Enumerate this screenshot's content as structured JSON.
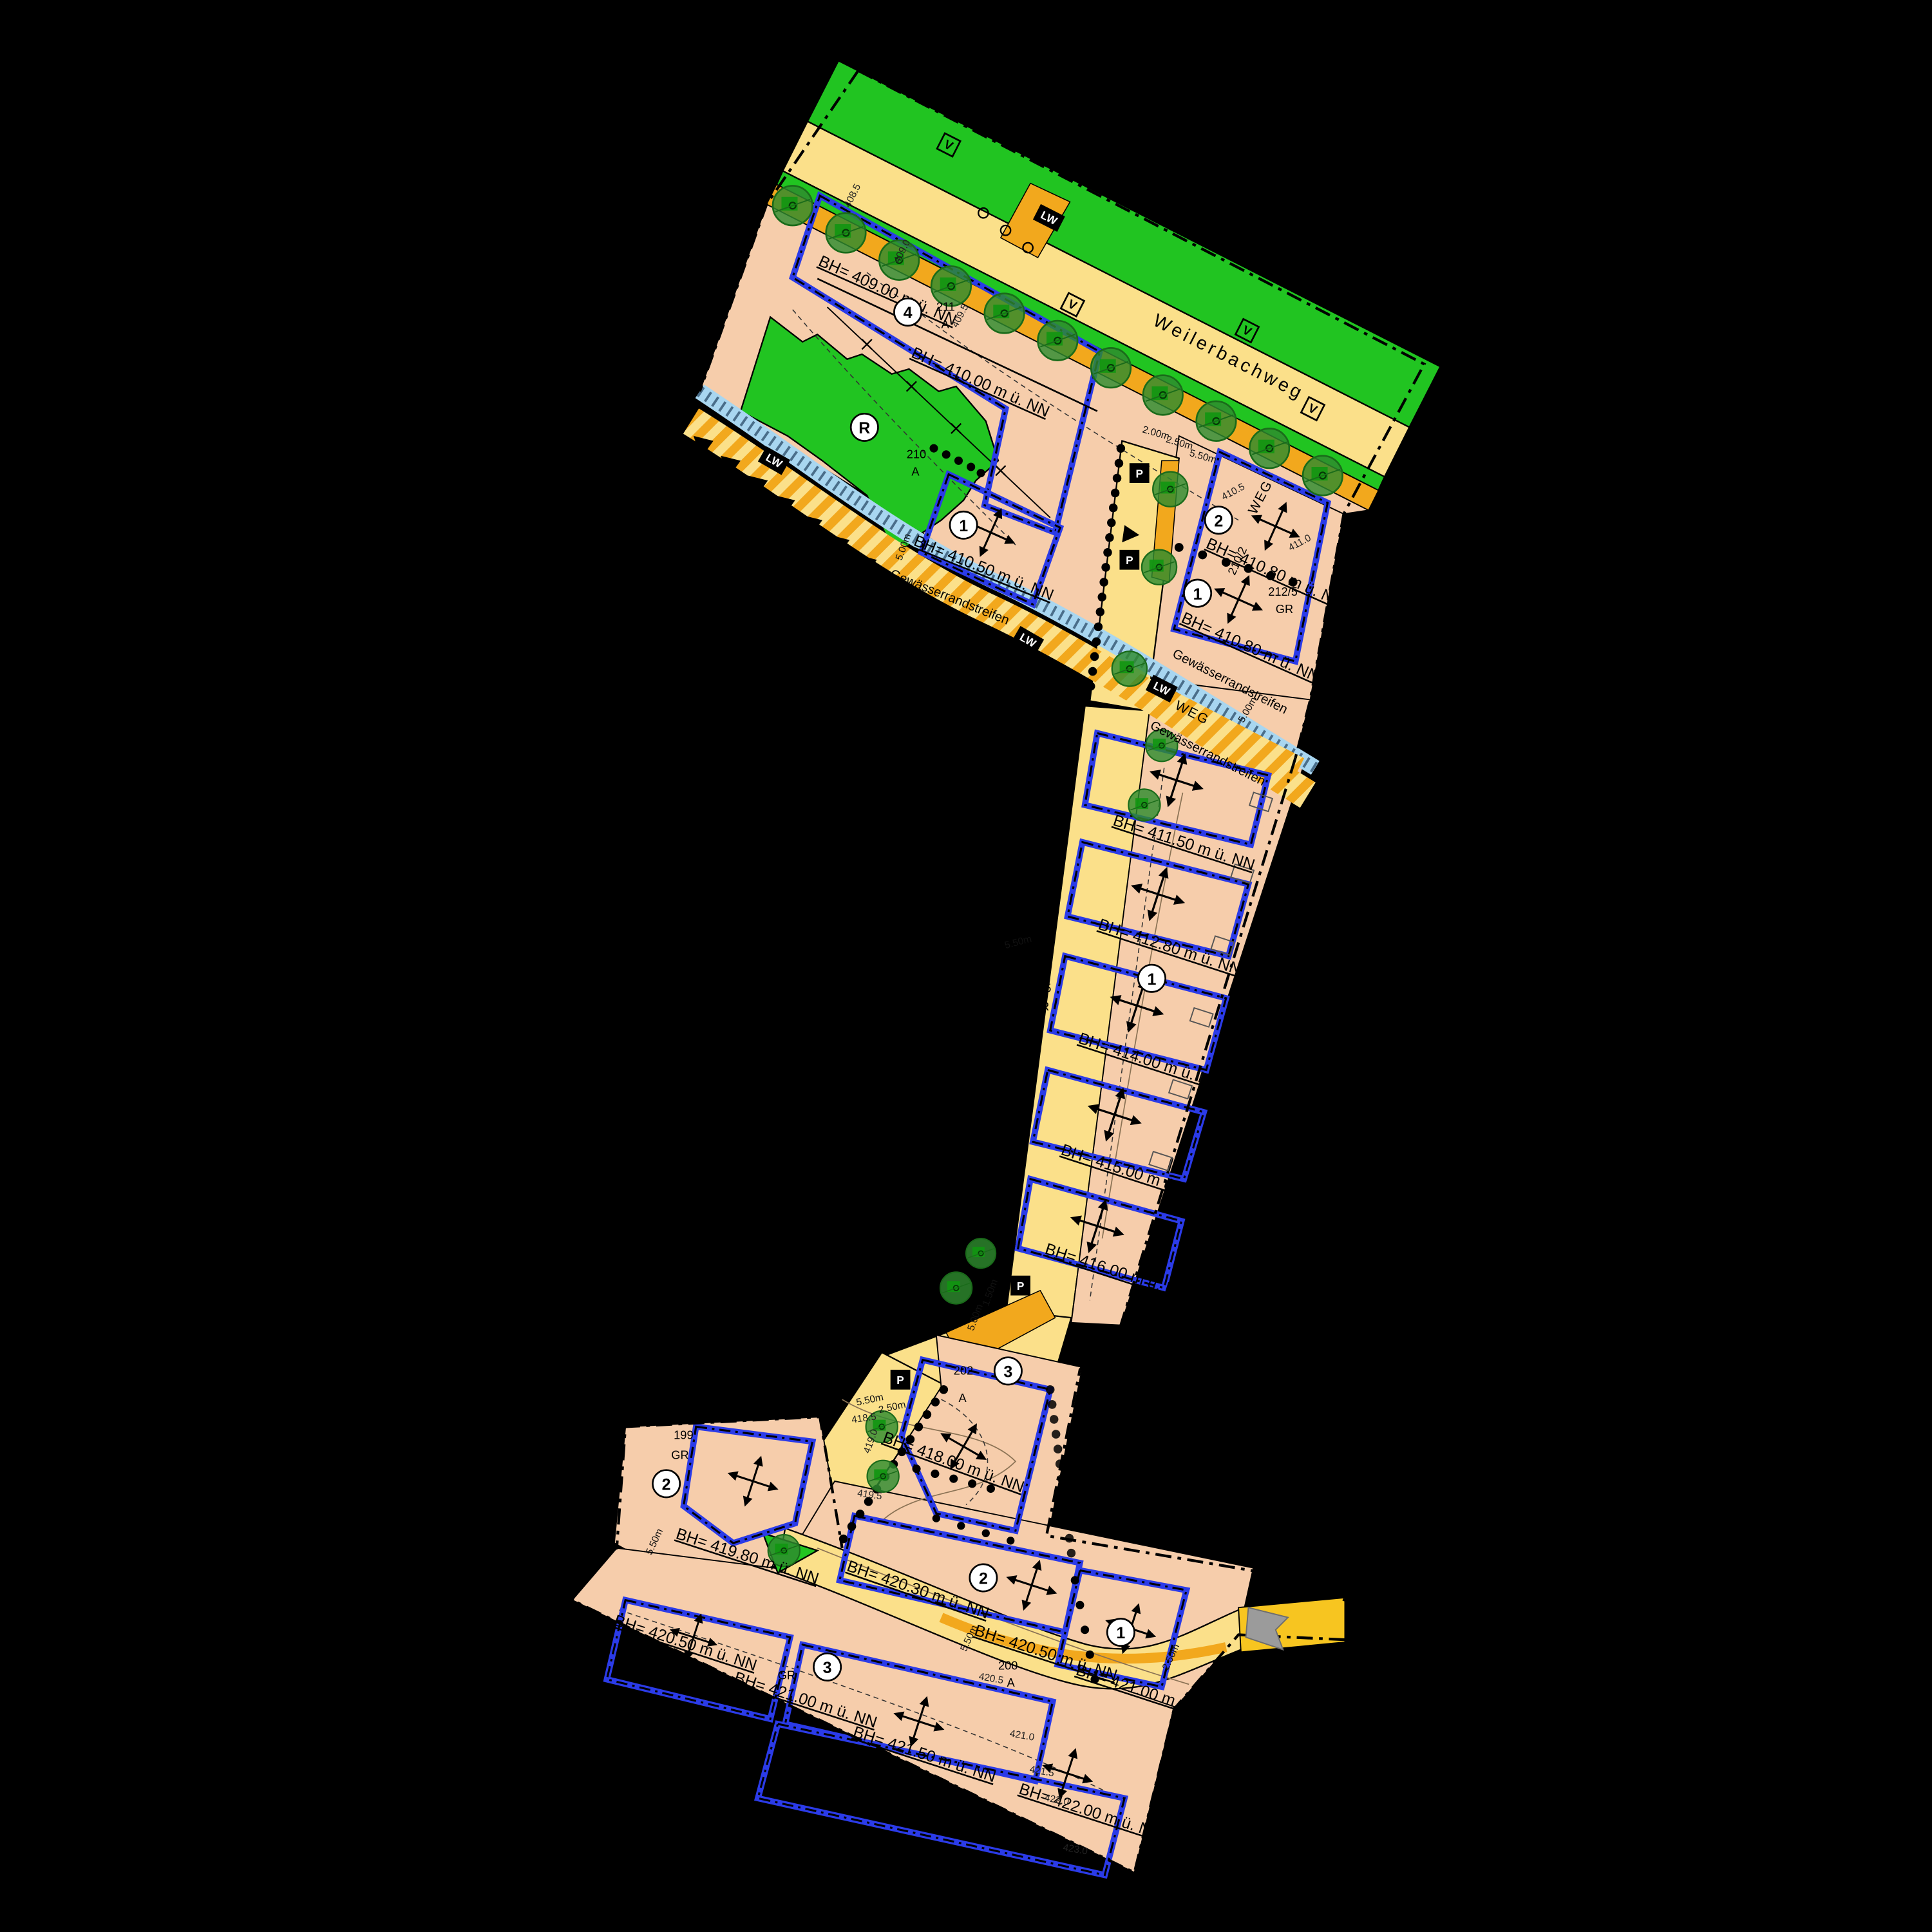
{
  "plan": {
    "street_name": "Weilerbachweg",
    "waterway_label": "Gewässerrandstreifen",
    "path_label": "WEG",
    "markers": {
      "lw": "LW",
      "p": "P",
      "v": "V"
    },
    "heights": [
      "BH= 409.00 m ü. NN",
      "BH= 410.00 m ü. NN",
      "BH= 410.50 m ü. NN",
      "BH= 410.80 m ü. NN",
      "BH= 410.80 m ü. NN",
      "BH= 411.50 m ü. NN",
      "BH= 412.80 m ü. NN",
      "BH= 414.00 m ü. NN",
      "BH= 415.00 m ü. NN",
      "BH= 416.00 m ü. NN",
      "BH= 418.00 m ü. NN",
      "BH= 419.80 m ü. NN",
      "BH= 420.30 m ü. NN",
      "BH= 420.50 m ü. NN",
      "BH= 420.50 m ü. NN",
      "BH= 421.00 m ü. NN",
      "BH= 421.00 m ü. NN",
      "BH= 421.50 m ü. NN",
      "BH= 422.00 m ü. NN"
    ],
    "zones": [
      "4",
      "1",
      "2",
      "1",
      "R",
      "1",
      "3",
      "2",
      "2",
      "1",
      "3"
    ],
    "parcels": {
      "p211": "211",
      "p211s": "A",
      "p210": "210",
      "p210s": "A",
      "p2102": "210/2",
      "p2125": "212/5",
      "p2125s": "GR",
      "p2104": "210/4",
      "p205": "205",
      "p205s": "GR",
      "p2021": "202/1",
      "p202": "202",
      "p202s": "A",
      "p199": "199",
      "p199s": "GR",
      "p200": "200",
      "p200s": "A",
      "gr": "GR"
    },
    "contours": [
      "408.5",
      "409.0",
      "409.5",
      "410.5",
      "411.0",
      "418.5",
      "419.0",
      "419.5",
      "420.5",
      "421.0",
      "421.5",
      "422.0",
      "423.0"
    ],
    "dims": {
      "d200": "2.00m",
      "d250": "2.50m",
      "d550": "5.50m",
      "d500": "5.00m",
      "d150": "1.50m"
    },
    "colors": {
      "background": "#000000",
      "plot": "#F6CDAB",
      "road": "#FBE08A",
      "road_accent": "#F2A81D",
      "green": "#21C421",
      "tree": "#2E8B2E",
      "water": "#A8D6F0",
      "window_line": "#2B3BE8",
      "exit_road": "#F7C520",
      "north_arrow": "#9B9B9B"
    }
  }
}
